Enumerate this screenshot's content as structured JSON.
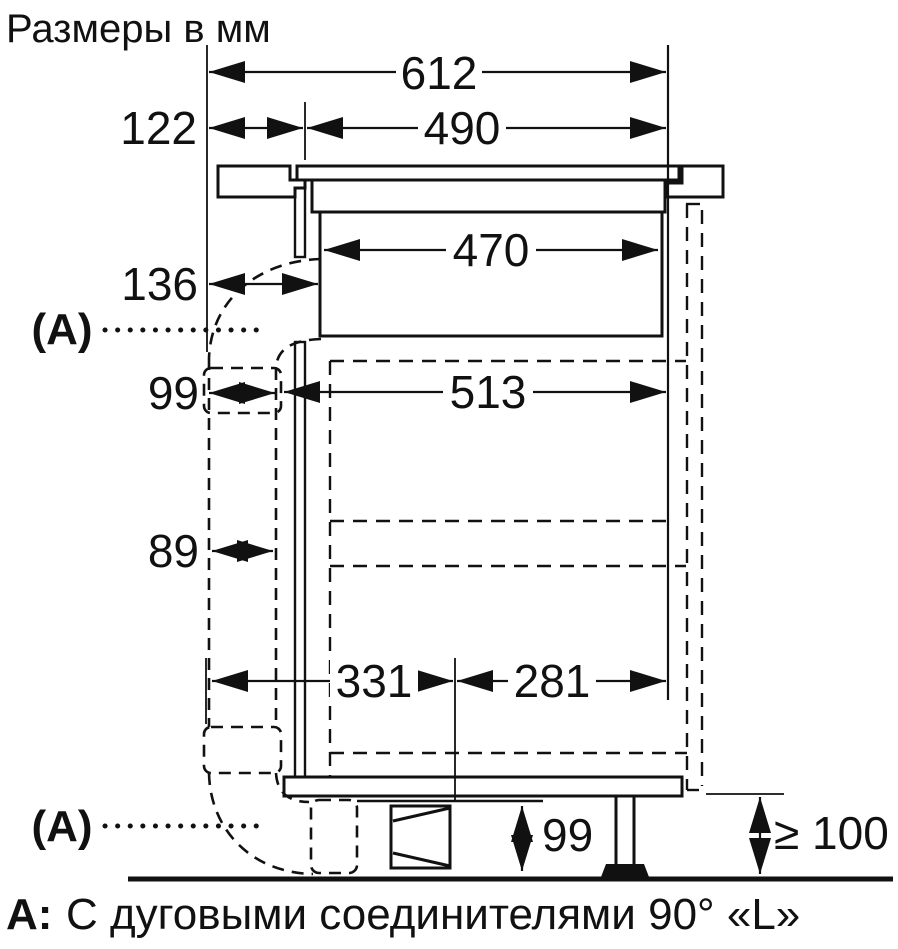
{
  "title": "Размеры в мм",
  "callouts": {
    "top": "(А)",
    "bottom": "(А)"
  },
  "dimensions": {
    "overall_width": "612",
    "left_offset": "122",
    "cutout_width": "490",
    "inner_width": "470",
    "duct_elbow_offset": "136",
    "elbow_connector_width": "99",
    "cabinet_inner_width": "513",
    "duct_depth": "89",
    "bottom_left_width": "331",
    "bottom_right_width": "281",
    "plinth_duct_height": "99",
    "floor_clearance": "≥ 100"
  },
  "note": {
    "lead": "А:",
    "text": "С дуговыми соединителями 90° «L»"
  },
  "colors": {
    "line": "#111111",
    "background": "#ffffff"
  }
}
